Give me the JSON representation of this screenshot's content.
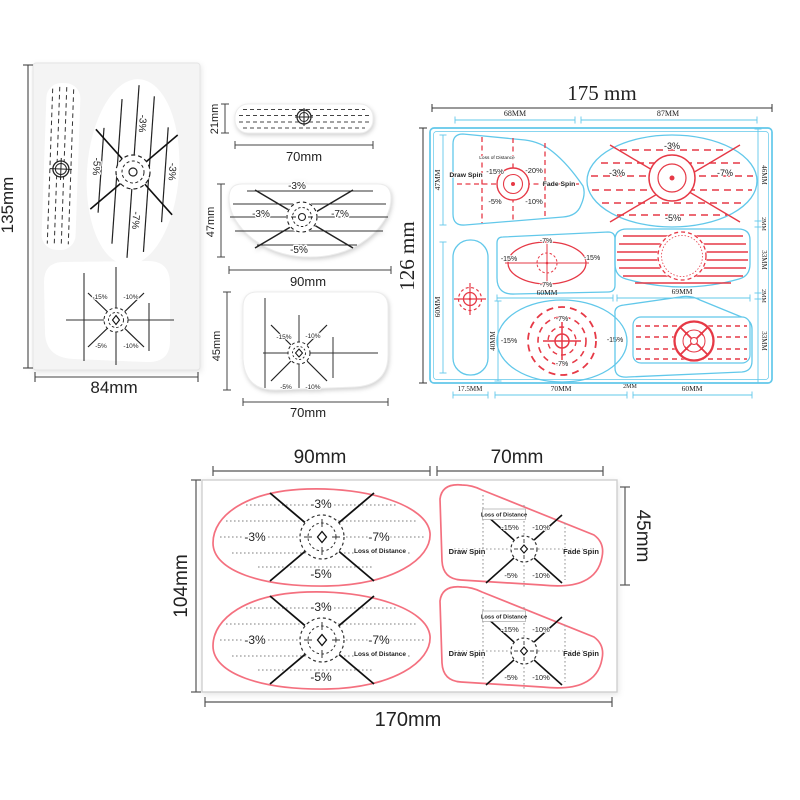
{
  "colors": {
    "blue_outline": "#62c8ea",
    "blue_text": "#3db8e4",
    "red": "#e63946",
    "pink": "#f4707f",
    "black_line": "#1a1a1a",
    "dotted_gray": "#999999",
    "dim_line": "#444444",
    "sheet_gray": "#f4f4f4"
  },
  "left_sheet": {
    "height_label": "135mm",
    "width_label": "84mm",
    "driver": {
      "top": "-3%",
      "left": "-5%",
      "right": "-3%",
      "bottom": "-7%"
    },
    "iron": {
      "tl": "-15%",
      "tr": "-10%",
      "bl": "-5%",
      "br": "-10%"
    }
  },
  "singles": {
    "putter": {
      "height": "21mm",
      "width": "70mm"
    },
    "driver": {
      "height": "47mm",
      "width": "90mm",
      "top": "-3%",
      "left": "-3%",
      "right": "-7%",
      "bottom": "-5%"
    },
    "iron": {
      "height": "45mm",
      "width": "70mm",
      "tl": "-15%",
      "tr": "-10%",
      "bl": "-5%",
      "br": "-10%"
    }
  },
  "blue_sheet": {
    "width_title": "175 mm",
    "height_title": "126 mm",
    "dims": {
      "top_left": "68MM",
      "top_right": "87MM",
      "iron_h": "47MM",
      "putter_h": "60MM",
      "hybrid_w": "60MM",
      "fairway_w": "69MM",
      "oval_h": "40MM",
      "right_1": "46MM",
      "right_2": "2MM",
      "right_3": "33MM",
      "right_4": "2MM",
      "right_5": "33MM",
      "bottom_1": "17.5MM",
      "bottom_2": "70MM",
      "bottom_3": "2MM",
      "bottom_4": "60MM"
    },
    "iron": {
      "lod": "Loss of Distance",
      "draw": "Draw Spin",
      "fade": "Fade Spin",
      "tl": "-15%",
      "tr": "-20%",
      "bl": "-5%",
      "br": "-10%"
    },
    "driver": {
      "top": "-3%",
      "left": "-3%",
      "right": "-7%",
      "bottom": "-5%"
    },
    "hybrid": {
      "top": "-7%",
      "left": "-15%",
      "right": "-15%",
      "bottom": "-7%"
    },
    "oval": {
      "top": "-7%",
      "left": "-15%",
      "right": "-15%",
      "bottom": "-7%"
    }
  },
  "bottom_sheet": {
    "dims": {
      "driver_w": "90mm",
      "iron_w": "70mm",
      "height": "104mm",
      "iron_h": "45mm",
      "width": "170mm"
    },
    "driver": {
      "top": "-3%",
      "left": "-3%",
      "right": "-7%",
      "lod": "Loss of Distance",
      "bottom": "-5%"
    },
    "iron": {
      "lod": "Loss of Distance",
      "draw": "Draw Spin",
      "fade": "Fade Spin",
      "tl": "-15%",
      "tr": "-10%",
      "bl": "-5%",
      "br": "-10%"
    }
  }
}
